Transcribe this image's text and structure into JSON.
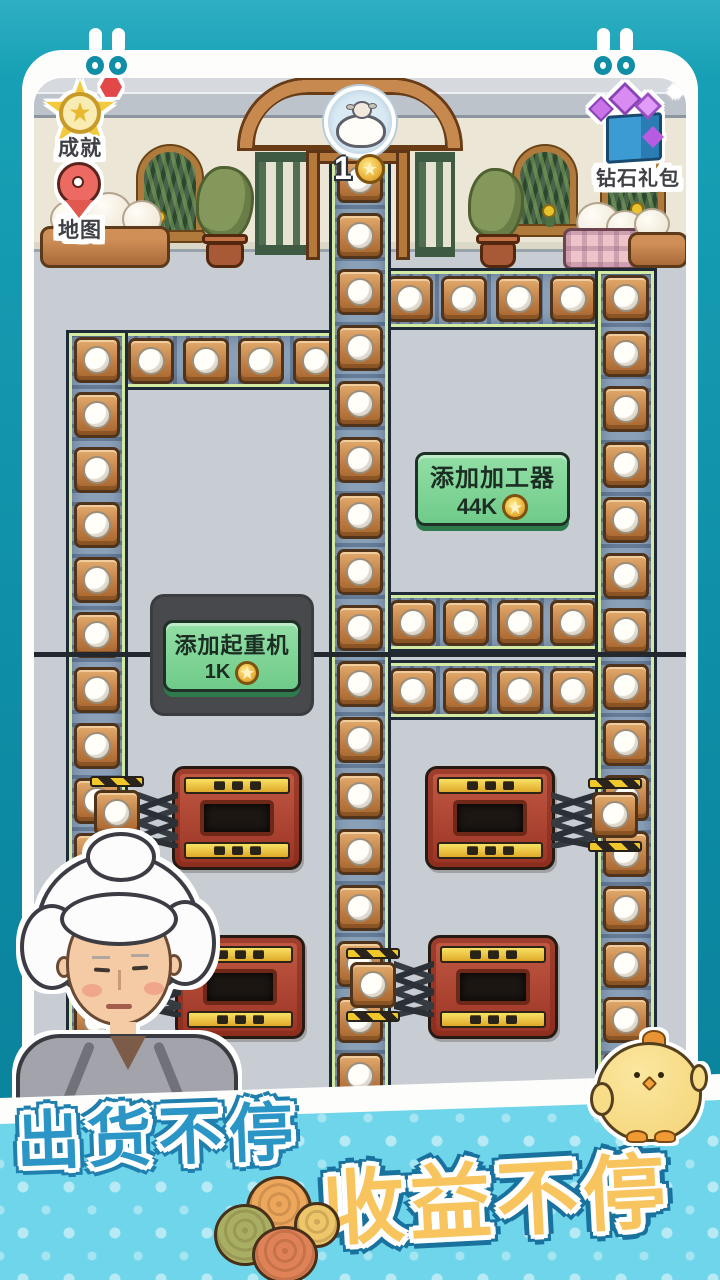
{
  "ui": {
    "achievement": {
      "label": "成就"
    },
    "map": {
      "label": "地图"
    },
    "diamond_pack": {
      "label": "钻石礼包",
      "sparkle": "✦"
    },
    "queue_badge": {
      "count": "1"
    },
    "buttons": {
      "add_processor": {
        "label": "添加加工器",
        "price": "44K"
      },
      "add_crane": {
        "label": "添加起重机",
        "price": "1K"
      }
    },
    "banner": {
      "slogan1": "出货不停",
      "slogan2": "收益不停"
    }
  },
  "colors": {
    "frame_teal": "#0d8ba4",
    "banner_cyan": "#6ed5ea",
    "slogan_blue": "#2b95c6",
    "slogan_gold": "#f7c45e",
    "button_green": "#7fd596",
    "machine_red": "#a83828",
    "belt_track": "#8aa0b8",
    "crate_brown": "#c07a42",
    "coin_gold": "#eab33a"
  },
  "scene": {
    "belts": [
      {
        "id": "left-horizontal",
        "x": 66,
        "y": 330,
        "w": 280,
        "h": 60,
        "dir": "h",
        "crates": 5
      },
      {
        "id": "top-right-horizontal",
        "x": 380,
        "y": 268,
        "w": 277,
        "h": 62,
        "dir": "h",
        "crates": 5
      },
      {
        "id": "mid-upper-horizontal",
        "x": 329,
        "y": 592,
        "w": 328,
        "h": 60,
        "dir": "h",
        "crates": 6
      },
      {
        "id": "mid-lower-horizontal",
        "x": 329,
        "y": 660,
        "w": 328,
        "h": 60,
        "dir": "h",
        "crates": 6
      },
      {
        "id": "left-vertical",
        "x": 66,
        "y": 330,
        "w": 62,
        "h": 776,
        "dir": "v",
        "crates": 14
      },
      {
        "id": "center-vertical",
        "x": 329,
        "y": 150,
        "w": 62,
        "h": 956,
        "dir": "v",
        "crates": 17
      },
      {
        "id": "right-vertical",
        "x": 595,
        "y": 268,
        "w": 62,
        "h": 838,
        "dir": "v",
        "crates": 15
      }
    ],
    "machines": [
      {
        "id": "left-top",
        "x": 172,
        "y": 766,
        "arm": "left",
        "clamp_x": 94,
        "clamp_y": 790
      },
      {
        "id": "left-bottom",
        "x": 175,
        "y": 935,
        "arm": "left",
        "clamp_x": 94,
        "clamp_y": 960
      },
      {
        "id": "right-top",
        "x": 425,
        "y": 766,
        "arm": "right",
        "clamp_x": 592,
        "clamp_y": 792
      },
      {
        "id": "right-bottom",
        "x": 428,
        "y": 935,
        "arm": "left",
        "clamp_x": 350,
        "clamp_y": 962
      }
    ]
  }
}
